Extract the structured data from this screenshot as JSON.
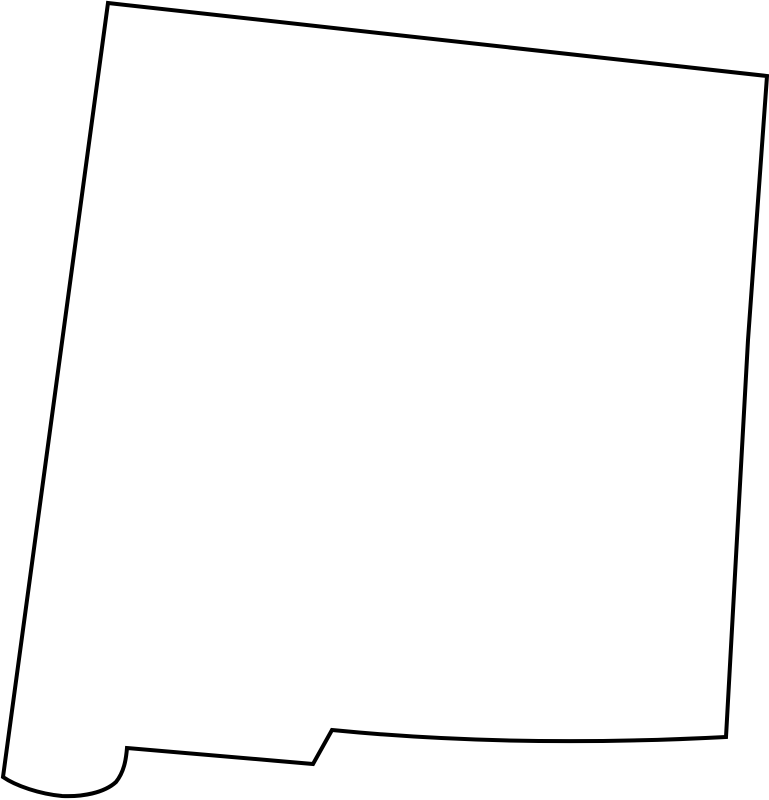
{
  "page": {
    "background_color": "#ffffff"
  },
  "map": {
    "region": "New Mexico",
    "description": "Blank outline map of the state of New Mexico",
    "stroke_color": "#000000",
    "fill_color": "#ffffff",
    "stroke_width": "4",
    "viewbox": "0 0 769 800",
    "path": "M 108 3 L 767 76 L 748 340 L 726 737 Q 515 748 332 730 L 313 764 L 127 748 C 126 760 124 772 116 782 C 104 793 82 797 62 796 C 40 794 16 786 3 777 Z"
  }
}
